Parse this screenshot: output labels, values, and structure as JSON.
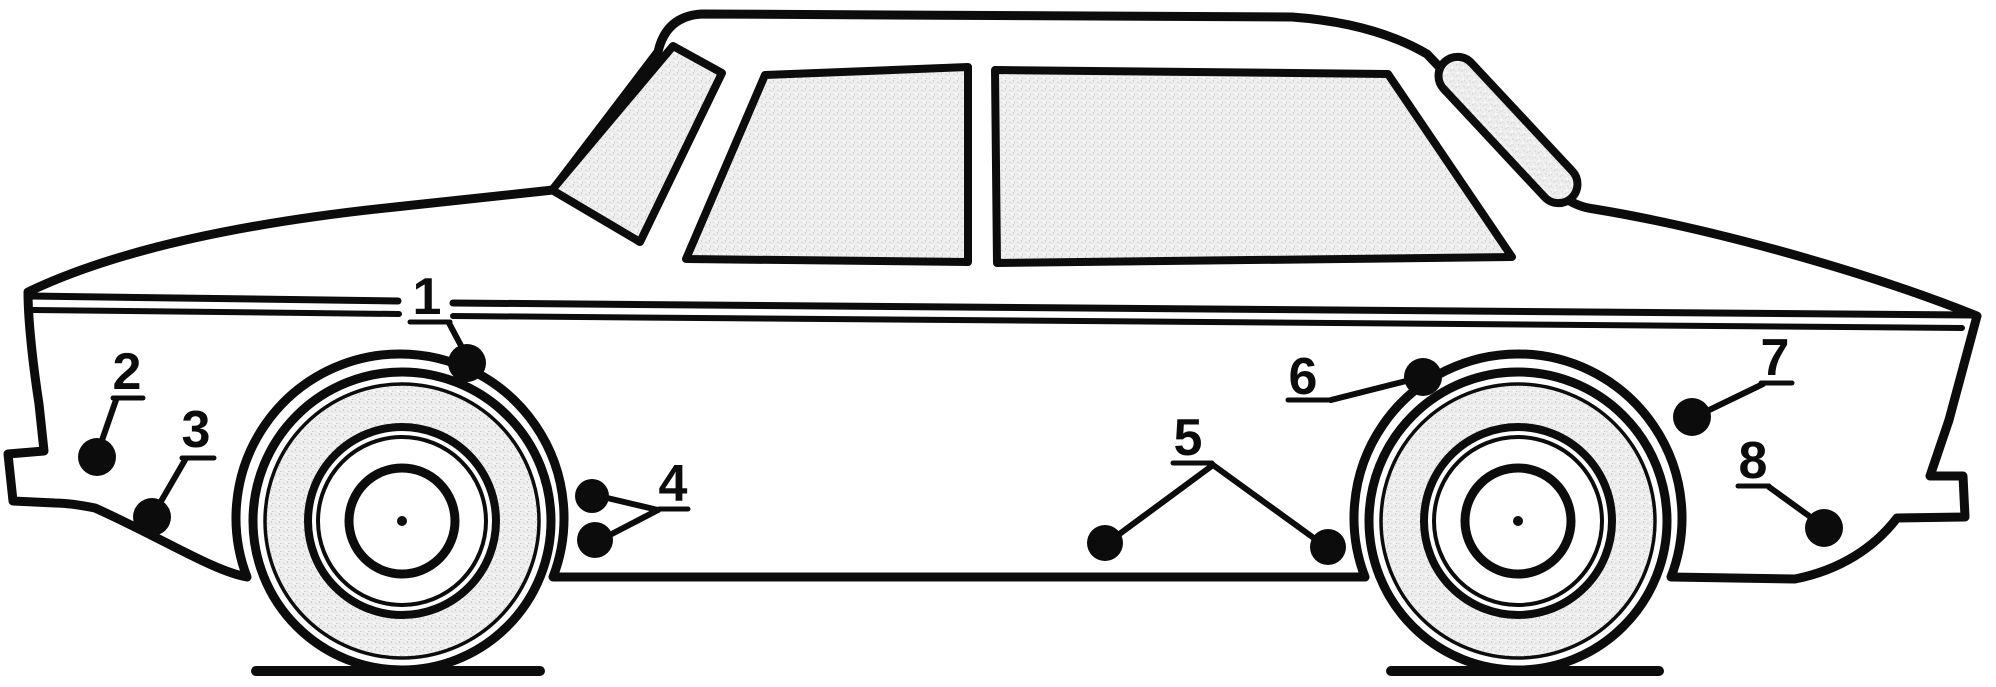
{
  "figure": {
    "kind": "car-side-view-technical-line-drawing",
    "marker_count": 8
  },
  "colors": {
    "ink": "#0c0c0c",
    "paper": "#ffffff",
    "glass_base": "#eeeeee",
    "glass_speck": "#cfcfcf"
  },
  "callouts": [
    {
      "label": "1",
      "digit": {
        "x": 427,
        "y": 296
      },
      "underline": [
        410,
        322,
        450,
        322
      ],
      "leaders": [
        [
          449,
          323,
          467,
          357
        ]
      ],
      "dots": [
        [
          467,
          363,
          19
        ]
      ]
    },
    {
      "label": "2",
      "digit": {
        "x": 127,
        "y": 371
      },
      "underline": [
        113,
        398,
        143,
        398
      ],
      "leaders": [
        [
          116,
          400,
          100,
          446
        ]
      ],
      "dots": [
        [
          97,
          457,
          19
        ]
      ]
    },
    {
      "label": "3",
      "digit": {
        "x": 196,
        "y": 429
      },
      "underline": [
        182,
        458,
        214,
        458
      ],
      "leaders": [
        [
          185,
          460,
          156,
          510
        ]
      ],
      "dots": [
        [
          152,
          517,
          19
        ]
      ]
    },
    {
      "label": "4",
      "digit": {
        "x": 673,
        "y": 483
      },
      "underline": [
        659,
        509,
        688,
        509
      ],
      "leaders": [
        [
          658,
          510,
          603,
          497
        ],
        [
          658,
          510,
          606,
          537
        ]
      ],
      "dots": [
        [
          592,
          496,
          17
        ],
        [
          595,
          540,
          18
        ]
      ]
    },
    {
      "label": "5",
      "digit": {
        "x": 1188,
        "y": 437
      },
      "underline": [
        1173,
        463,
        1212,
        463
      ],
      "leaders": [
        [
          1213,
          465,
          1110,
          541
        ],
        [
          1213,
          465,
          1322,
          544
        ]
      ],
      "dots": [
        [
          1105,
          543,
          18
        ],
        [
          1328,
          547,
          18
        ]
      ]
    },
    {
      "label": "6",
      "digit": {
        "x": 1303,
        "y": 376
      },
      "underline": [
        1288,
        400,
        1331,
        400
      ],
      "leaders": [
        [
          1331,
          400,
          1410,
          380
        ]
      ],
      "dots": [
        [
          1423,
          377,
          19
        ]
      ]
    },
    {
      "label": "7",
      "digit": {
        "x": 1775,
        "y": 357
      },
      "underline": [
        1761,
        383,
        1792,
        383
      ],
      "leaders": [
        [
          1763,
          384,
          1703,
          413
        ]
      ],
      "dots": [
        [
          1692,
          417,
          19
        ]
      ]
    },
    {
      "label": "8",
      "digit": {
        "x": 1753,
        "y": 460
      },
      "underline": [
        1738,
        486,
        1769,
        486
      ],
      "leaders": [
        [
          1769,
          487,
          1816,
          521
        ]
      ],
      "dots": [
        [
          1824,
          528,
          19
        ]
      ]
    }
  ]
}
